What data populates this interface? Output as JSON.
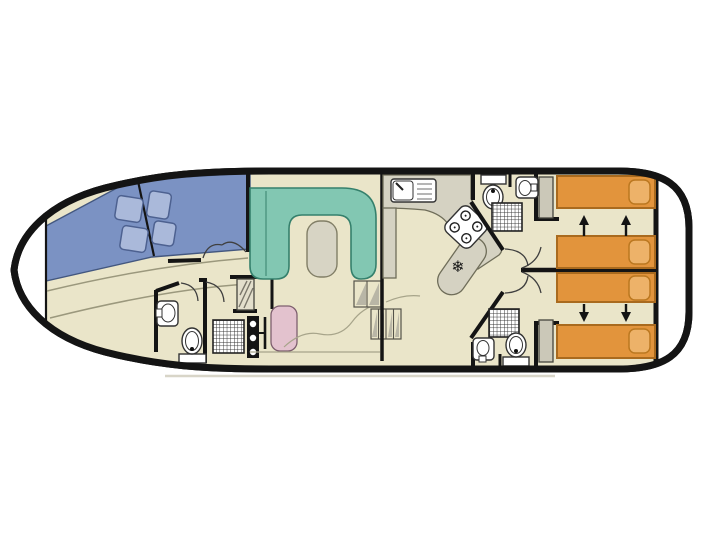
{
  "title": "houseboat-deck-plan",
  "symbols": {
    "fridge": "❄"
  },
  "colors": {
    "hull_black": "#141414",
    "floor_cream": "#eae5c9",
    "deck_blue": "#7b92c3",
    "cushion_blue": "#aab9da",
    "sofa_teal": "#82c7b2",
    "table_gray": "#d7d4c4",
    "counter_gray": "#d5d2c2",
    "bed_orange": "#e2943c",
    "pillow_orange": "#edb269",
    "seat_pink": "#e3c2ce",
    "wardrobe_gray": "#cbc8b8",
    "shadow_gray": "#d8d5c8"
  },
  "legend": {
    "areas": [
      "bow-locker",
      "bow-sun-deck",
      "forward-bathroom",
      "helm-station",
      "saloon",
      "galley",
      "aft-bathroom-top",
      "aft-bathroom-bottom",
      "aft-cabin-top",
      "aft-cabin-bottom",
      "stern-deck"
    ],
    "furniture_counts": {
      "sun_cushions": 4,
      "u_shaped_sofa": 1,
      "saloon_table": 1,
      "single_beds": 2,
      "sliding_double_beds": 2,
      "toilets": 3,
      "showers": 3,
      "bathroom_sinks": 3,
      "galley_sink": 1,
      "hob_burners": 4,
      "fridge": 1,
      "wardrobes": 3,
      "helm_seat": 1,
      "steering_wheel": 1,
      "companionway_steps": 2
    }
  }
}
